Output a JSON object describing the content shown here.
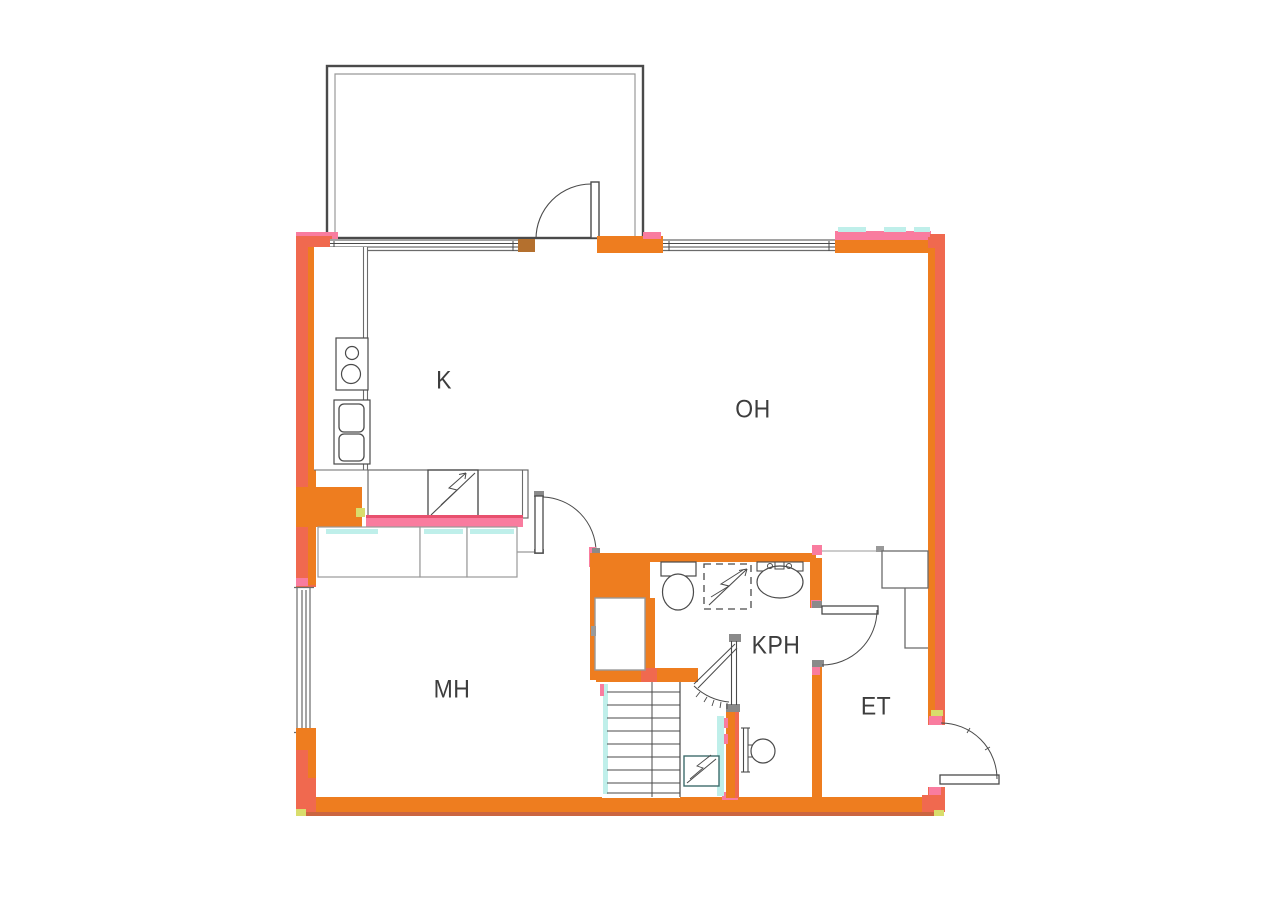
{
  "title": "apartment-floor-plan",
  "colors": {
    "wall_orange": "#EE7D1F",
    "wall_coral": "#F0694F",
    "wall_pink": "#F97C9F",
    "wall_red": "#E8506E",
    "jamb_tan": "#B4702E",
    "glass_cyan": "#BFEFEA",
    "accent_yellow": "#D9DD6C",
    "dark_edge": "#C24A1E"
  },
  "rooms": [
    {
      "id": "kitchen",
      "label": "K"
    },
    {
      "id": "living-room",
      "label": "OH"
    },
    {
      "id": "bedroom",
      "label": "MH"
    },
    {
      "id": "bathroom",
      "label": "KPH"
    },
    {
      "id": "entry",
      "label": "ET"
    }
  ]
}
